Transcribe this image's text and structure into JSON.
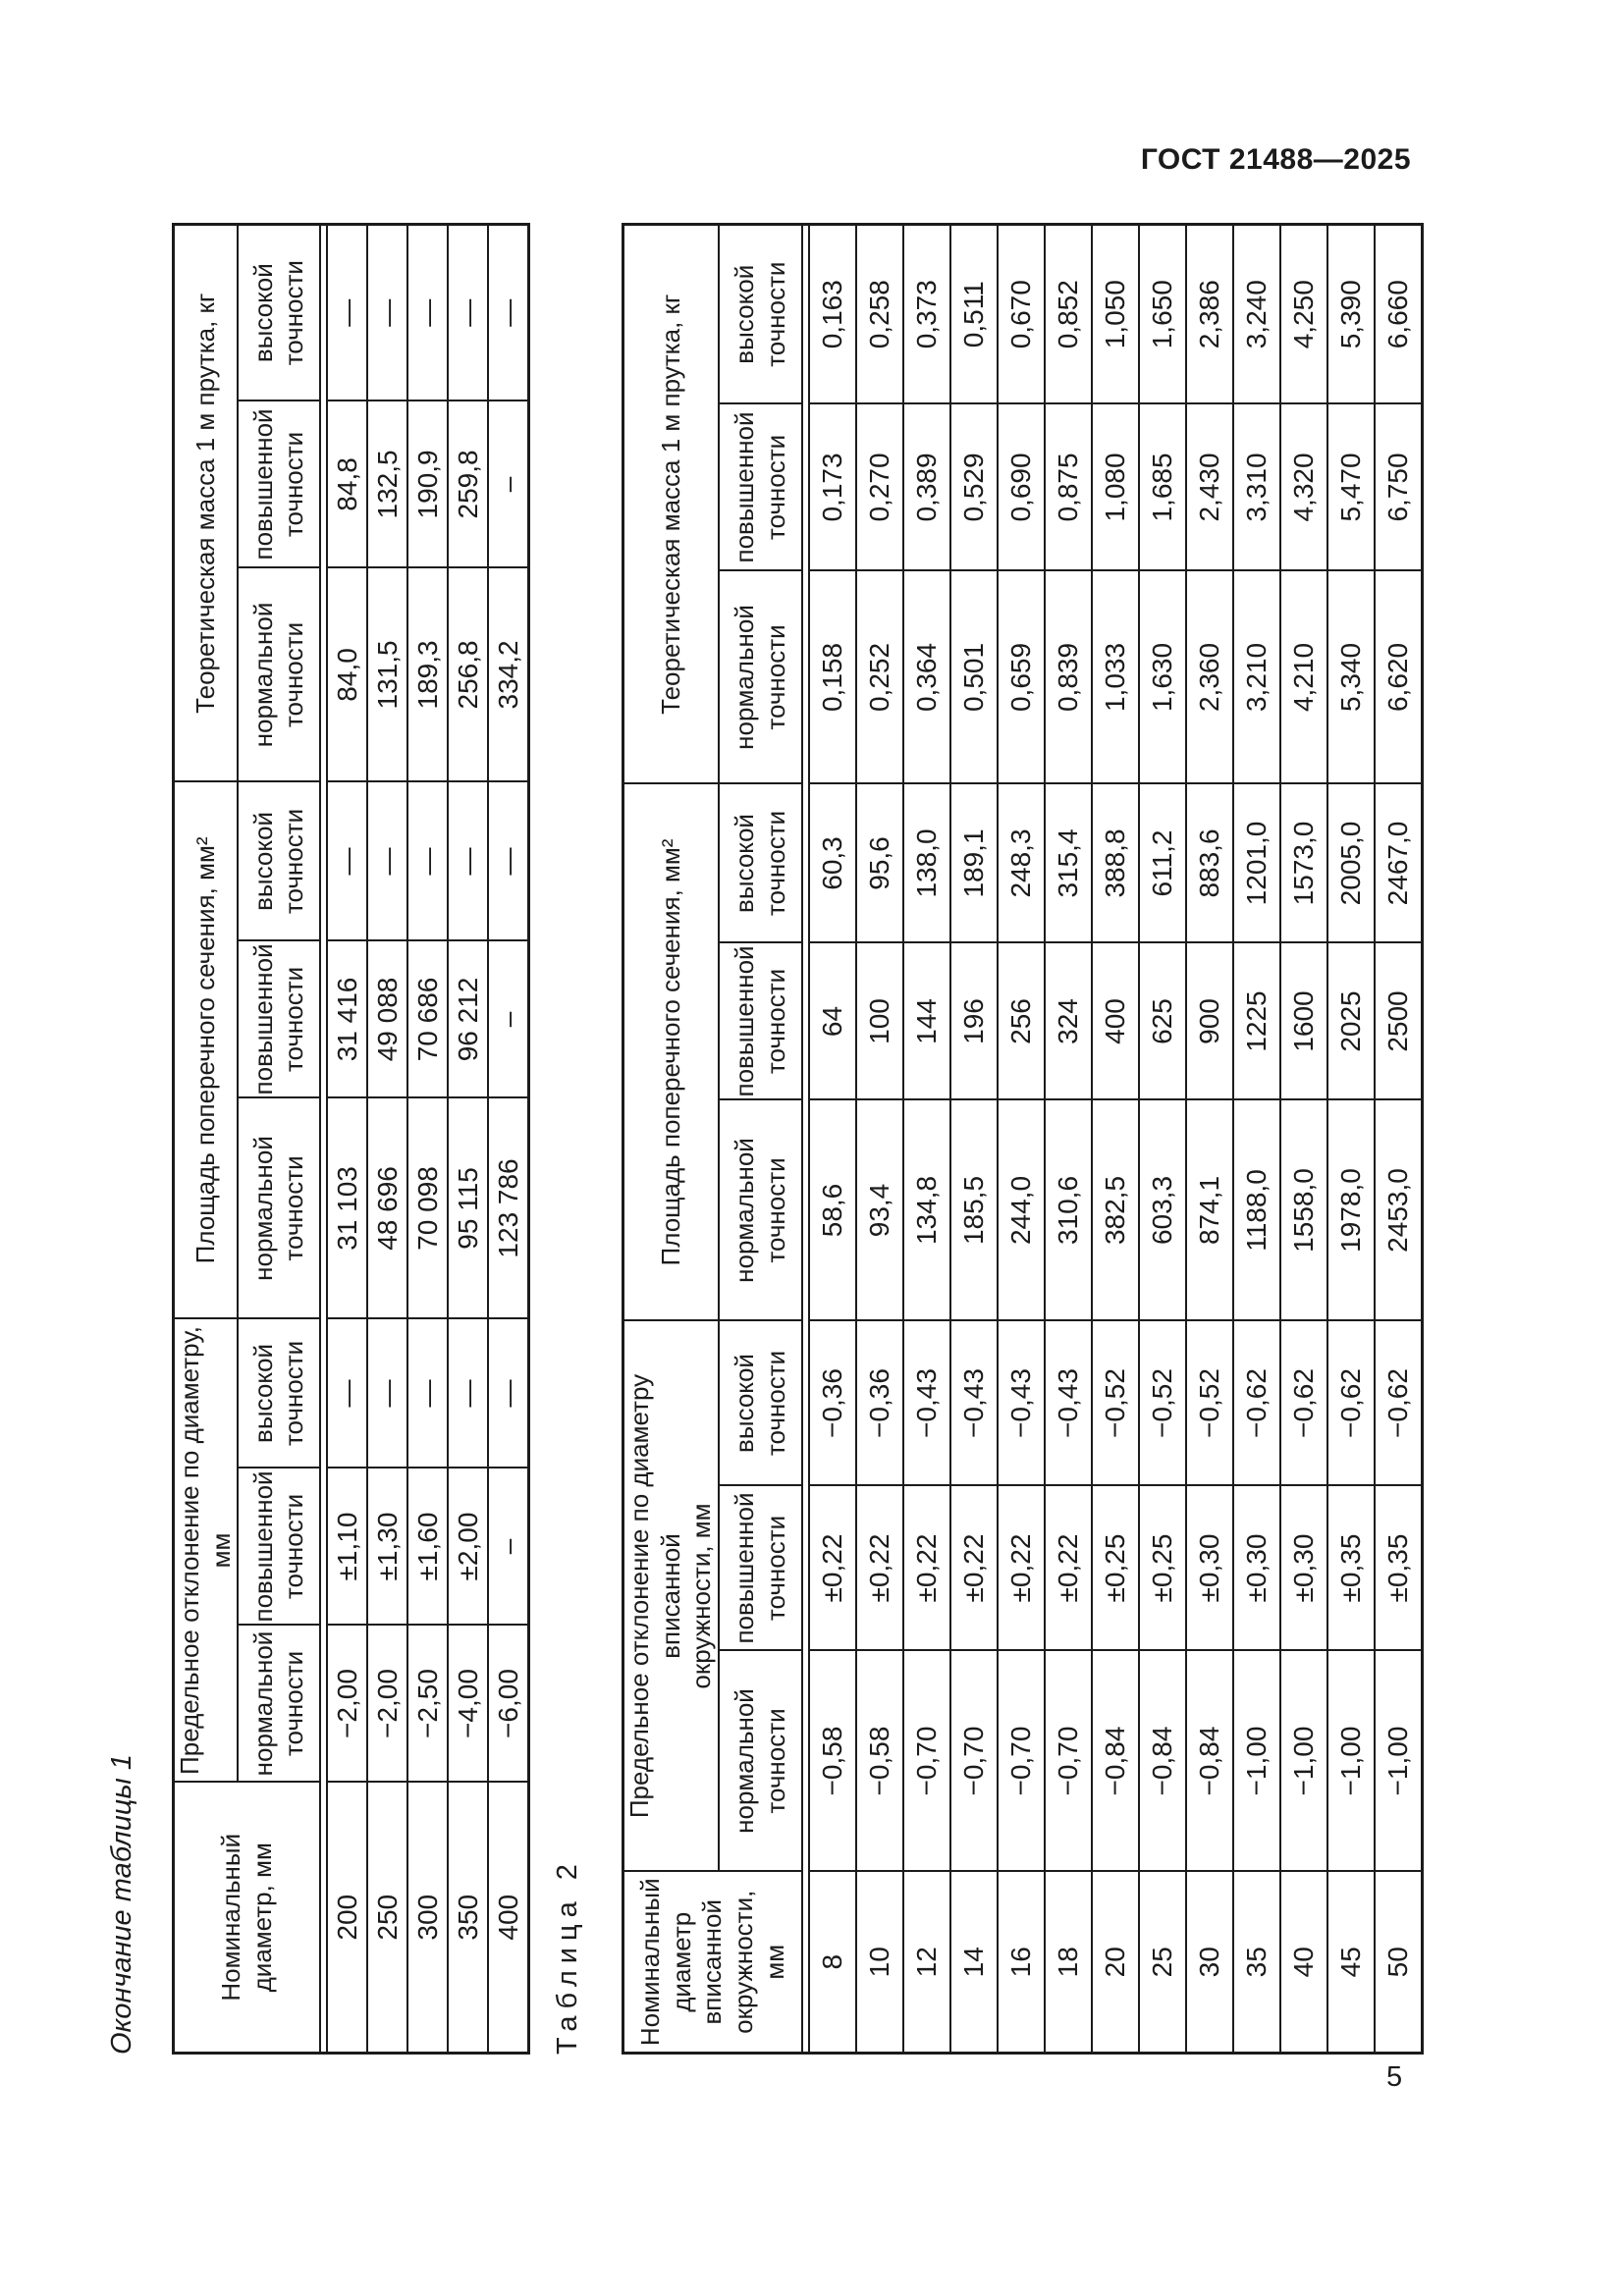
{
  "page": {
    "standard_code": "ГОСТ 21488—2025",
    "page_number": "5"
  },
  "subheads": [
    "нормальной\nточности",
    "повышенной\nточности",
    "высокой\nточности"
  ],
  "table1": {
    "caption": "Окончание таблицы 1",
    "head": {
      "diameter": "Номинальный\nдиаметр, мм",
      "deviation": "Предельное отклонение по диаметру, мм",
      "area": "Площадь поперечного сечения, мм²",
      "mass": "Теоретическая масса 1 м прутка, кг"
    },
    "rows": [
      [
        "200",
        "−2,00",
        "±1,10",
        "—",
        "31 103",
        "31 416",
        "—",
        "84,0",
        "84,8",
        "—"
      ],
      [
        "250",
        "−2,00",
        "±1,30",
        "—",
        "48 696",
        "49 088",
        "—",
        "131,5",
        "132,5",
        "—"
      ],
      [
        "300",
        "−2,50",
        "±1,60",
        "—",
        "70 098",
        "70 686",
        "—",
        "189,3",
        "190,9",
        "—"
      ],
      [
        "350",
        "−4,00",
        "±2,00",
        "—",
        "95 115",
        "96 212",
        "—",
        "256,8",
        "259,8",
        "—"
      ],
      [
        "400",
        "−6,00",
        "–",
        "—",
        "123 786",
        "–",
        "—",
        "334,2",
        "–",
        "—"
      ]
    ]
  },
  "table2": {
    "caption": "Таблица 2",
    "head": {
      "diameter": "Номинальный\nдиаметр\nвписанной\nокружности, мм",
      "deviation": "Предельное отклонение по диаметру вписанной\nокружности, мм",
      "area": "Площадь поперечного сечения, мм²",
      "mass": "Теоретическая масса 1 м прутка, кг"
    },
    "rows": [
      [
        "8",
        "−0,58",
        "±0,22",
        "−0,36",
        "58,6",
        "64",
        "60,3",
        "0,158",
        "0,173",
        "0,163"
      ],
      [
        "10",
        "−0,58",
        "±0,22",
        "−0,36",
        "93,4",
        "100",
        "95,6",
        "0,252",
        "0,270",
        "0,258"
      ],
      [
        "12",
        "−0,70",
        "±0,22",
        "−0,43",
        "134,8",
        "144",
        "138,0",
        "0,364",
        "0,389",
        "0,373"
      ],
      [
        "14",
        "−0,70",
        "±0,22",
        "−0,43",
        "185,5",
        "196",
        "189,1",
        "0,501",
        "0,529",
        "0,511"
      ],
      [
        "16",
        "−0,70",
        "±0,22",
        "−0,43",
        "244,0",
        "256",
        "248,3",
        "0,659",
        "0,690",
        "0,670"
      ],
      [
        "18",
        "−0,70",
        "±0,22",
        "−0,43",
        "310,6",
        "324",
        "315,4",
        "0,839",
        "0,875",
        "0,852"
      ],
      [
        "20",
        "−0,84",
        "±0,25",
        "−0,52",
        "382,5",
        "400",
        "388,8",
        "1,033",
        "1,080",
        "1,050"
      ],
      [
        "25",
        "−0,84",
        "±0,25",
        "−0,52",
        "603,3",
        "625",
        "611,2",
        "1,630",
        "1,685",
        "1,650"
      ],
      [
        "30",
        "−0,84",
        "±0,30",
        "−0,52",
        "874,1",
        "900",
        "883,6",
        "2,360",
        "2,430",
        "2,386"
      ],
      [
        "35",
        "−1,00",
        "±0,30",
        "−0,62",
        "1188,0",
        "1225",
        "1201,0",
        "3,210",
        "3,310",
        "3,240"
      ],
      [
        "40",
        "−1,00",
        "±0,30",
        "−0,62",
        "1558,0",
        "1600",
        "1573,0",
        "4,210",
        "4,320",
        "4,250"
      ],
      [
        "45",
        "−1,00",
        "±0,35",
        "−0,62",
        "1978,0",
        "2025",
        "2005,0",
        "5,340",
        "5,470",
        "5,390"
      ],
      [
        "50",
        "−1,00",
        "±0,35",
        "−0,62",
        "2453,0",
        "2500",
        "2467,0",
        "6,620",
        "6,750",
        "6,660"
      ]
    ]
  }
}
